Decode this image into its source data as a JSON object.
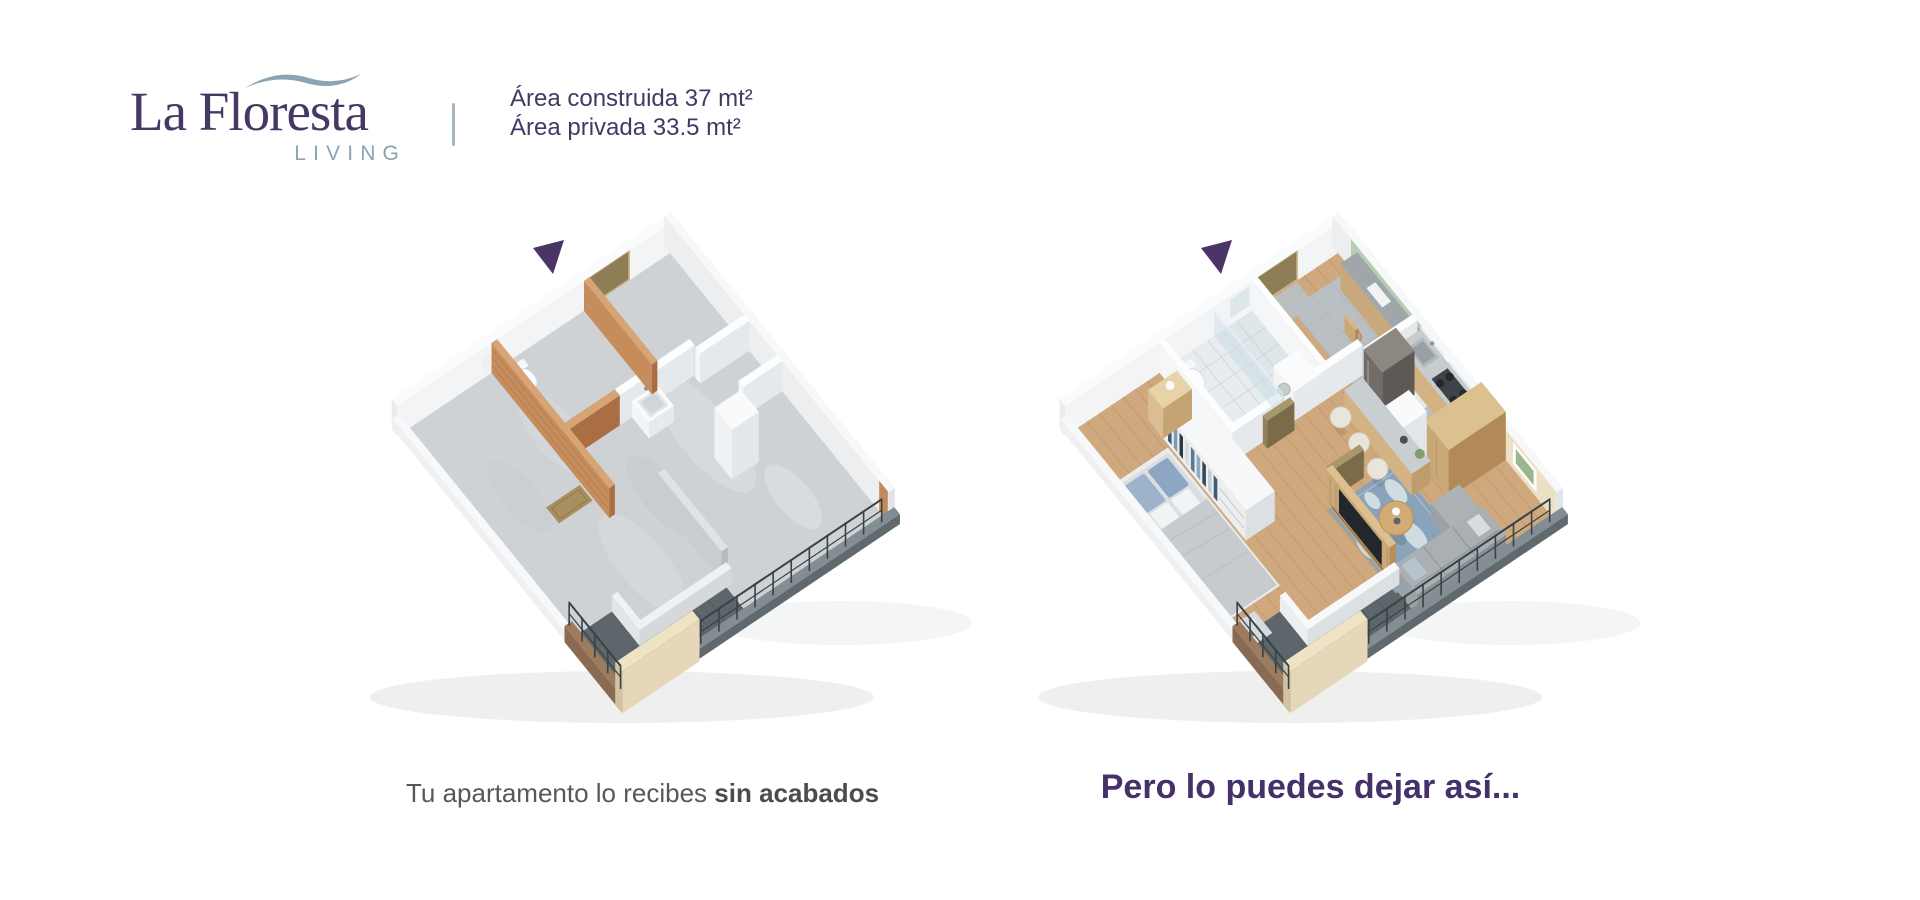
{
  "brand": {
    "title": "La Floresta",
    "subtitle": "LIVING"
  },
  "specs": {
    "line1": "Área construida 37 mt²",
    "line2": "Área privada 33.5 mt²"
  },
  "plans": {
    "left": {
      "caption_prefix": "Tu apartamento lo recibes",
      "caption_emphasis": "sin acabados"
    },
    "right": {
      "caption": "Pero lo puedes dejar así..."
    }
  },
  "colors": {
    "brand_purple": "#463765",
    "brand_blue": "#8ba4b1",
    "caption_purple": "#46306a",
    "caption_gray": "#57585a",
    "marker_purple": "#4a3566",
    "divider_blue": "#a3b8c2"
  }
}
